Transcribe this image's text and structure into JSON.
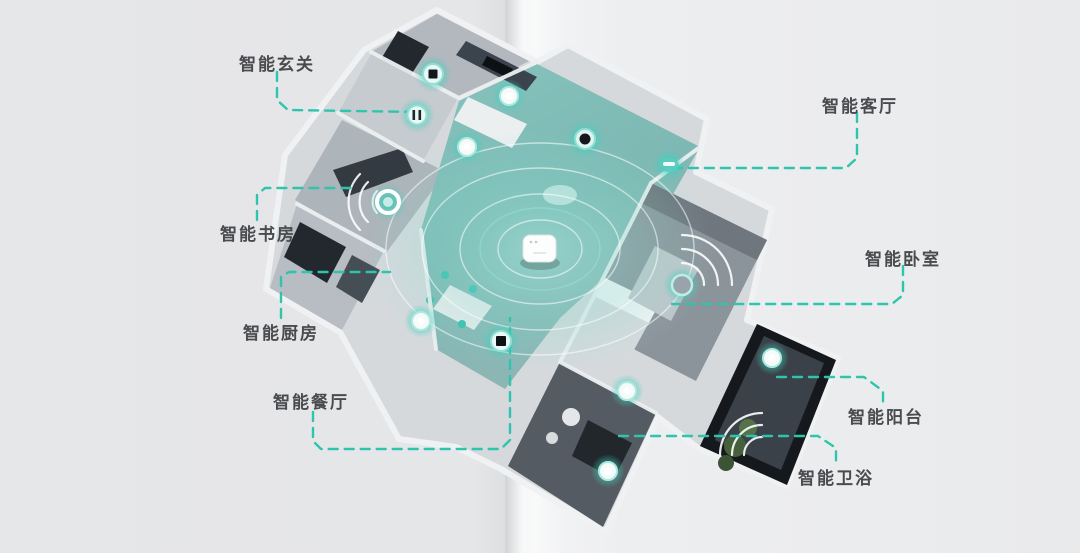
{
  "page": {
    "background_color": "#e8e9eb",
    "accent_color": "#2fc4ae",
    "label_color": "#4a4b4e",
    "glow_color": "#4fd0bf"
  },
  "diagram": {
    "type": "smart-home-isometric-floorplan",
    "zones": [
      {
        "id": "entrance",
        "label": "智能玄关"
      },
      {
        "id": "living",
        "label": "智能客厅"
      },
      {
        "id": "study",
        "label": "智能书房"
      },
      {
        "id": "kitchen",
        "label": "智能厨房"
      },
      {
        "id": "dining",
        "label": "智能餐厅"
      },
      {
        "id": "bedroom",
        "label": "智能卧室"
      },
      {
        "id": "balcony",
        "label": "智能阳台"
      },
      {
        "id": "bathroom",
        "label": "智能卫浴"
      }
    ],
    "hub": {
      "name": "central-smart-gateway",
      "icon": "white-rounded-hub"
    },
    "devices": [
      "entrance-smart-panel",
      "hallway-smart-switch",
      "living-ceiling-sensor-1",
      "living-ceiling-sensor-2",
      "living-smart-speaker",
      "living-wall-controller",
      "study-smart-socket",
      "kitchen-sensor",
      "dining-smart-panel",
      "bedroom-sensor",
      "balcony-sensor",
      "bathroom-sensor-1",
      "bathroom-sensor-2"
    ],
    "wifi_signal_zones": [
      "study",
      "bedroom",
      "balcony"
    ]
  }
}
